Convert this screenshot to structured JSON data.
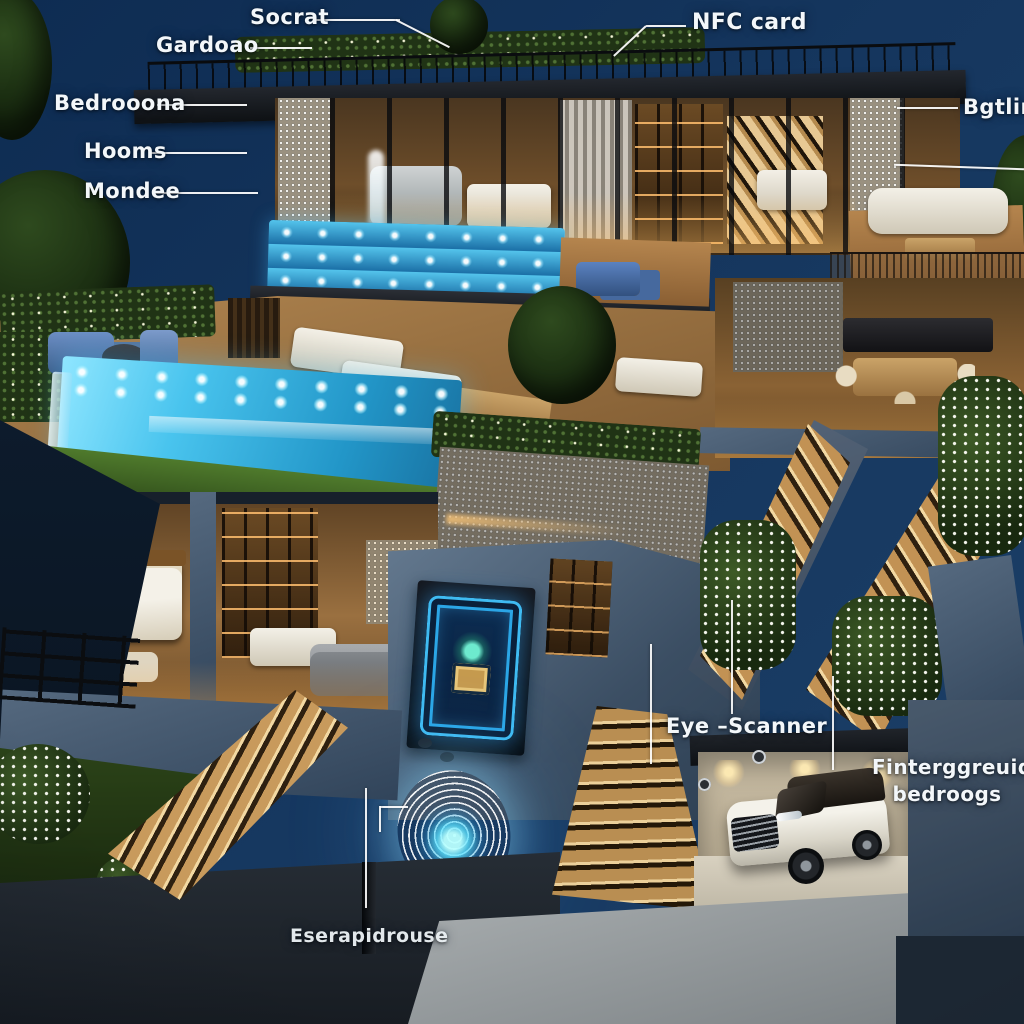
{
  "scene": {
    "description": "Night-time photorealistic 3D cutaway illustration of a multi-level luxury smart home with rooftop garden, infinity pool, glass aquarium pool, lit garden staircases, basement security wall with glowing circuit panel and neon fingerprint scanner, and an underground garage with a white SUV",
    "colors": {
      "sky_top": "#0e2c52",
      "sky_bottom_right": "#1c4068",
      "pool_water": "#45c2ee",
      "aquarium_deep": "#1a7cab",
      "warm_interior_light": "#e8b96d",
      "wood_deck": "#a97f4f",
      "concrete_blue": "#51677e",
      "roof_black": "#15181d",
      "neon_cyan": "#5fd6ff",
      "label_white": "#f3f7fa",
      "car_white": "#ece9e0"
    }
  },
  "labels": {
    "secret": {
      "text": "Socrat"
    },
    "garage": {
      "text": "Gardoao"
    },
    "nfc_card": {
      "text": "NFC card"
    },
    "bedrooms": {
      "text": "Bedrooona"
    },
    "rooms": {
      "text": "Hooms"
    },
    "mondee": {
      "text": "Mondee"
    },
    "bathing": {
      "text": "Bgtlin"
    },
    "eye_scanner": {
      "text": "Eye –Scanner"
    },
    "fingerprint": {
      "line1": "Finterggreuid",
      "line2": "bedroogs"
    },
    "escape": {
      "text": "Eserapidrouse"
    }
  }
}
